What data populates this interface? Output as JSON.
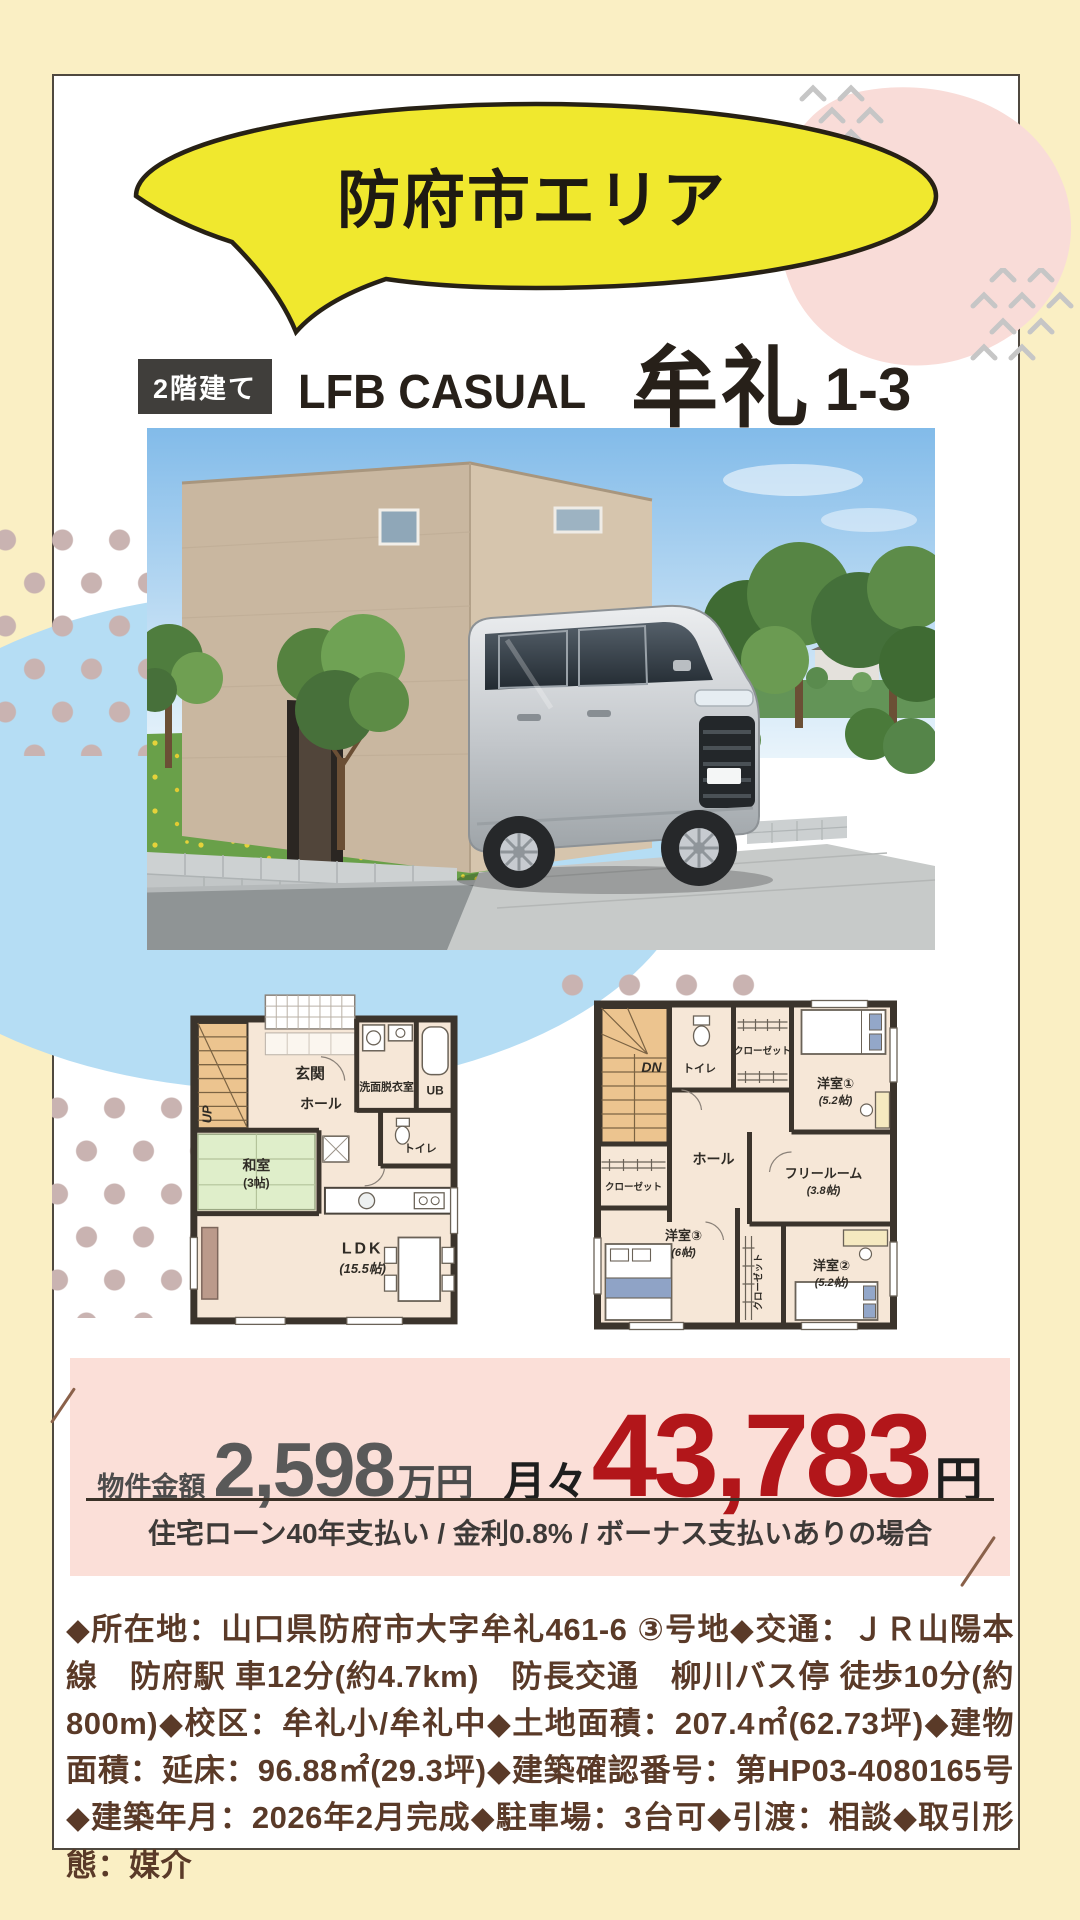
{
  "page": {
    "area_label": "防府市エリア",
    "badge": "2階建て",
    "brand": "LFB CASUAL",
    "property_name": "牟礼",
    "lot_number": "1-3"
  },
  "floor_plan_1f": {
    "rooms": {
      "stairs": "UP",
      "genkan": "玄関",
      "washroom": "洗面脱衣室",
      "ub": "UB",
      "hall": "ホール",
      "toilet": "トイレ",
      "washitsu": "和室",
      "washitsu_size": "(3帖)",
      "ldk": "LDK",
      "ldk_size": "(15.5帖)"
    }
  },
  "floor_plan_2f": {
    "rooms": {
      "stairs": "DN",
      "toilet": "トイレ",
      "closet_top": "クローゼット",
      "bedroom1": "洋室①",
      "bedroom1_size": "(5.2帖)",
      "hall": "ホール",
      "closet_mid": "クローゼット",
      "free_room": "フリールーム",
      "free_room_size": "(3.8帖)",
      "bedroom3": "洋室③",
      "bedroom3_size": "(6帖)",
      "closet_bottom": "クローゼット",
      "bedroom2": "洋室②",
      "bedroom2_size": "(5.2帖)"
    }
  },
  "price": {
    "label": "物件金額",
    "amount": "2,598",
    "amount_unit": "万円",
    "monthly_prefix": "月々",
    "monthly_amount": "43,783",
    "monthly_unit": "円",
    "loan_conditions": "住宅ローン40年支払い / 金利0.8% / ボーナス支払いありの場合"
  },
  "details": {
    "text": "◆所在地：山口県防府市大字牟礼461-6 ③号地◆交通：ＪＲ山陽本線　防府駅 車12分(約4.7km)　防長交通　柳川バス停 徒歩10分(約800m)◆校区：牟礼小/牟礼中◆土地面積：207.4㎡(62.73坪)◆建物面積：延床：96.88㎡(29.3坪)◆建築確認番号：第HP03-4080165号◆建築年月：2026年2月完成◆駐車場：3台可◆引渡：相談◆取引形態：媒介"
  },
  "colors": {
    "page_bg": "#faefc4",
    "bubble_yellow": "#f0e82e",
    "pink_blob": "#f9dcd8",
    "blue_blob": "#b5ddf4",
    "banner_pink": "#fbdfd8",
    "price_red": "#b2161a",
    "detail_brown": "#5a3a28"
  }
}
